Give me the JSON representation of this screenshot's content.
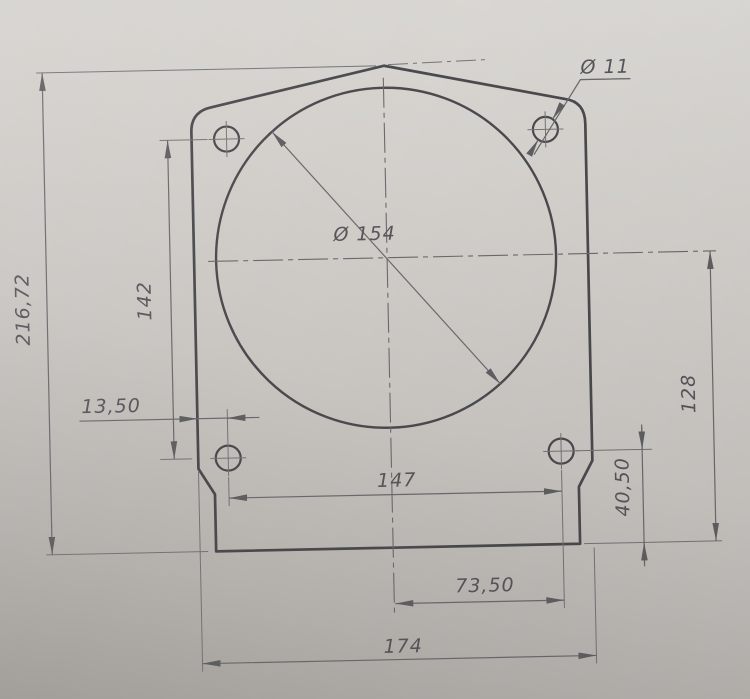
{
  "drawing": {
    "type": "engineering-drawing-photo",
    "part": "flange mounting plate, front view",
    "decimal_separator": ",",
    "labels": {
      "overall_height": "216,72",
      "hole_vertical_spacing": "142",
      "edge_to_hole": "13,50",
      "hole_diameter": "Ø 11",
      "bore_diameter": "Ø 154",
      "bottom_hole_spacing": "147",
      "center_to_hole_half": "73,50",
      "overall_width": "174",
      "center_to_bottom": "128",
      "hole_to_bottom_edge": "40,50"
    },
    "colors": {
      "paper_light": "#dcdad6",
      "paper_dark": "#a19e99",
      "outline": "#4a4a4e",
      "dimension_line": "#6a696c",
      "text": "#56565a"
    }
  }
}
